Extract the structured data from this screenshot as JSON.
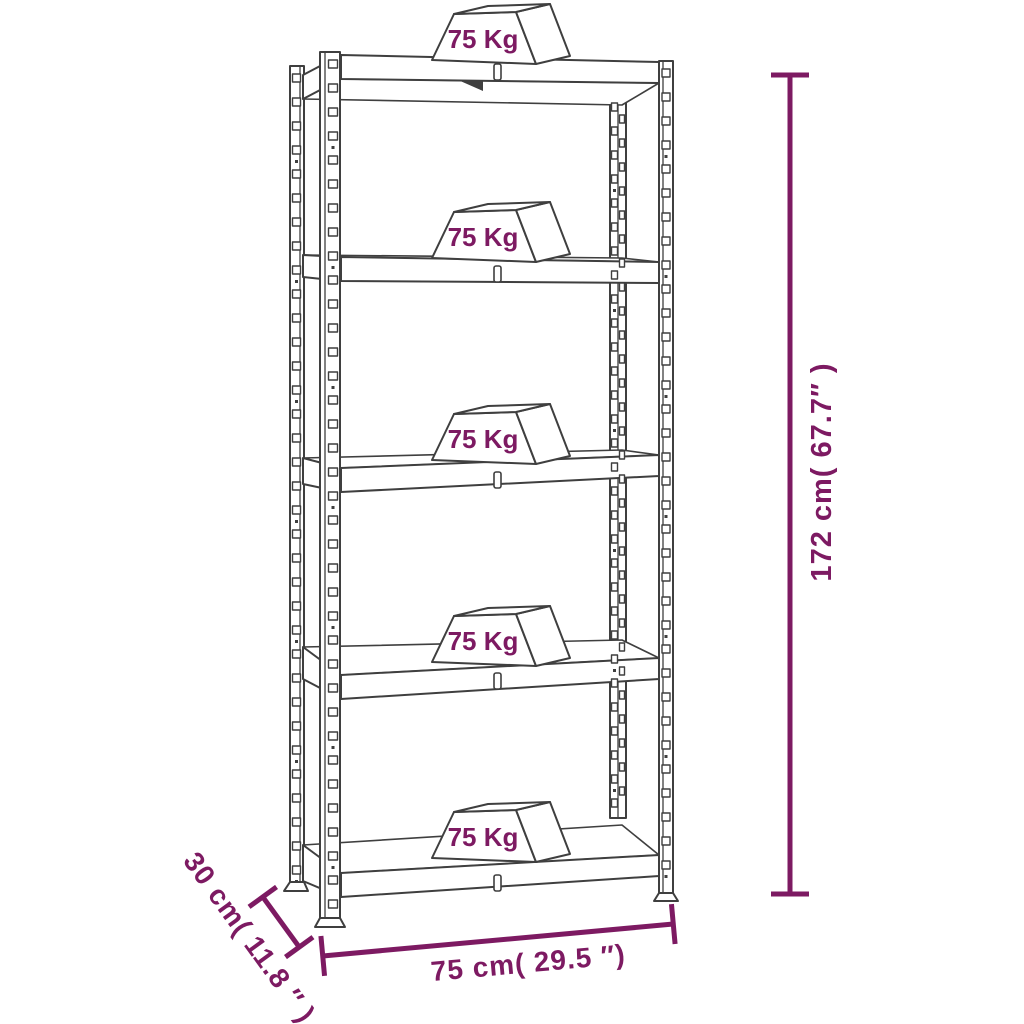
{
  "diagram": {
    "colors": {
      "line": "#3F3F3F",
      "accent": "#7D1A62",
      "background": "#FFFFFF"
    },
    "rack": {
      "shelf_count": 5,
      "shelves": [
        {
          "load_label": "75 Kg"
        },
        {
          "load_label": "75 Kg"
        },
        {
          "load_label": "75 Kg"
        },
        {
          "load_label": "75 Kg"
        },
        {
          "load_label": "75 Kg"
        }
      ]
    },
    "dimensions": {
      "height_label": "172 cm( 67.7″ )",
      "width_label": "75 cm( 29.5 ″)",
      "depth_label": "30 cm( 11.8 ″ )"
    }
  }
}
